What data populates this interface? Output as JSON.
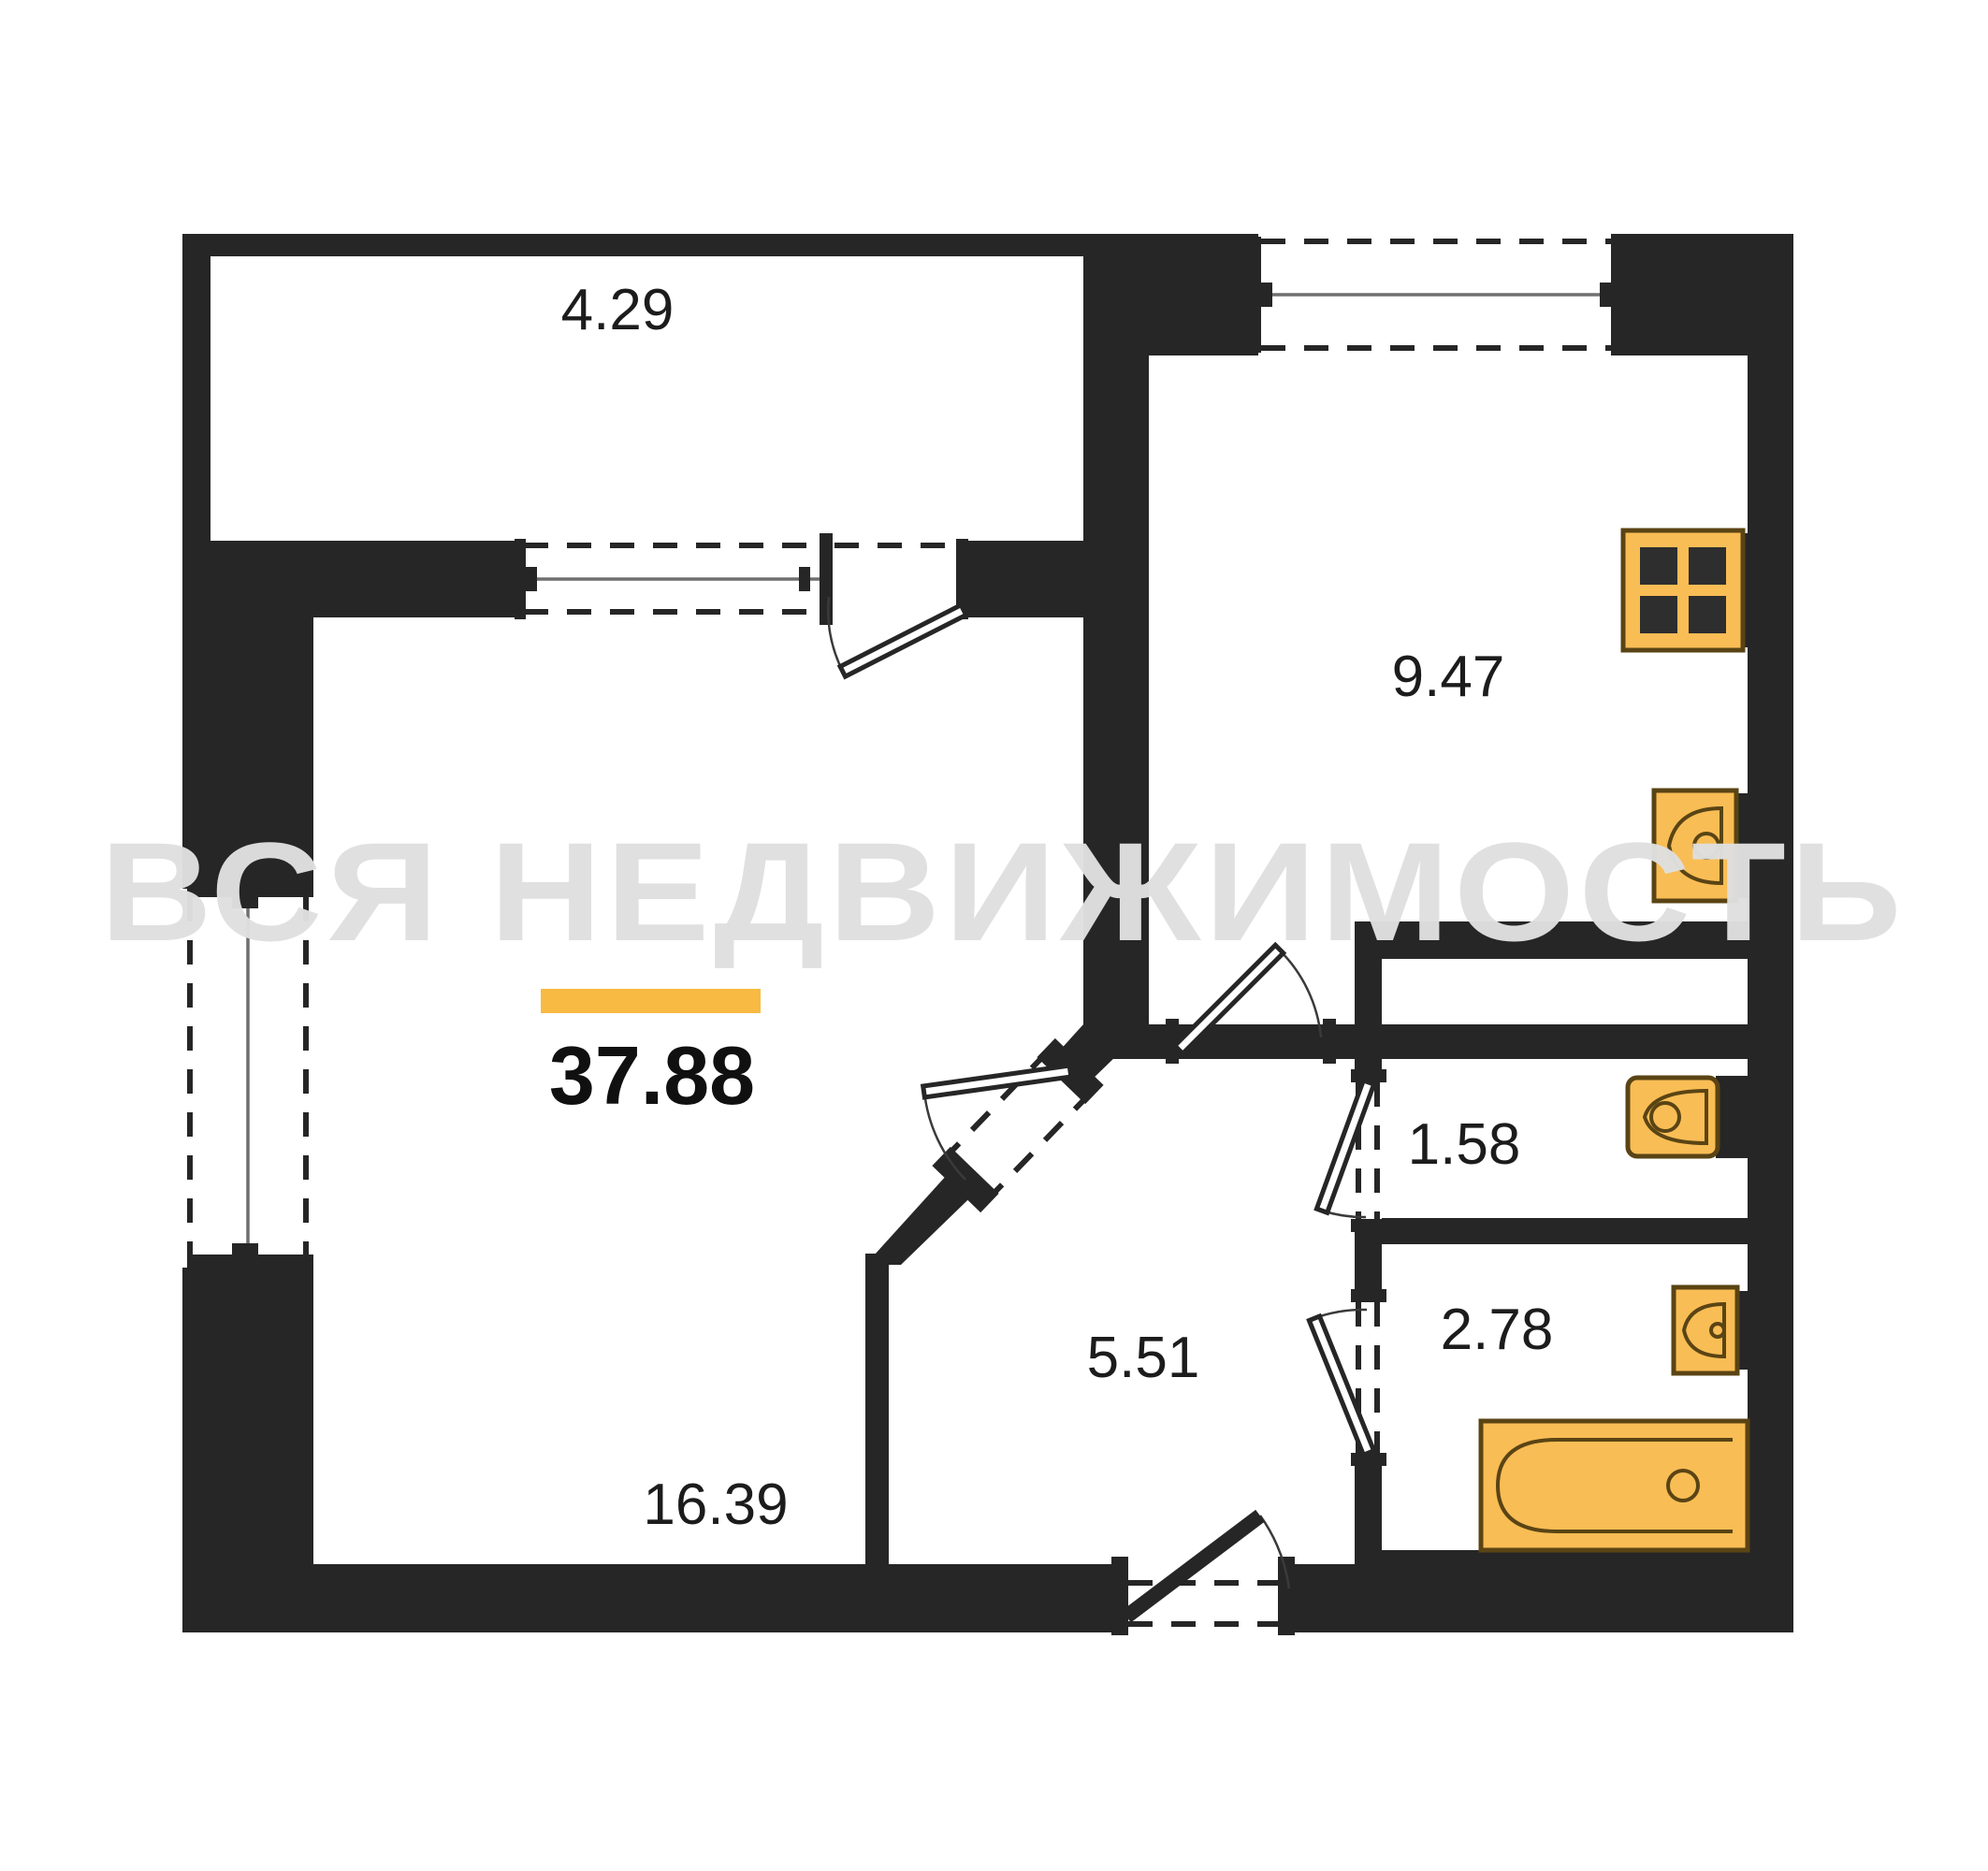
{
  "plan": {
    "watermark": "ВСЯ НЕДВИЖИМОСТЬ",
    "total_area": "37.88",
    "rooms": {
      "balcony": "4.29",
      "kitchen": "9.47",
      "living_room": "16.39",
      "hallway": "5.51",
      "wc": "1.58",
      "bathroom": "2.78"
    }
  },
  "colors": {
    "wall": "#262626",
    "text": "#1c1c1c",
    "accent": "#f8ba43",
    "fixture_fill": "#f9bd55",
    "fixture_stroke": "#5a4414",
    "watermark": "#e0e0e0",
    "background": "#ffffff"
  },
  "icons": {
    "stove": "stove-icon",
    "kitchen_sink": "kitchen-sink-icon",
    "toilet": "toilet-icon",
    "bathroom_sink": "sink-icon",
    "bathtub": "bathtub-icon"
  }
}
